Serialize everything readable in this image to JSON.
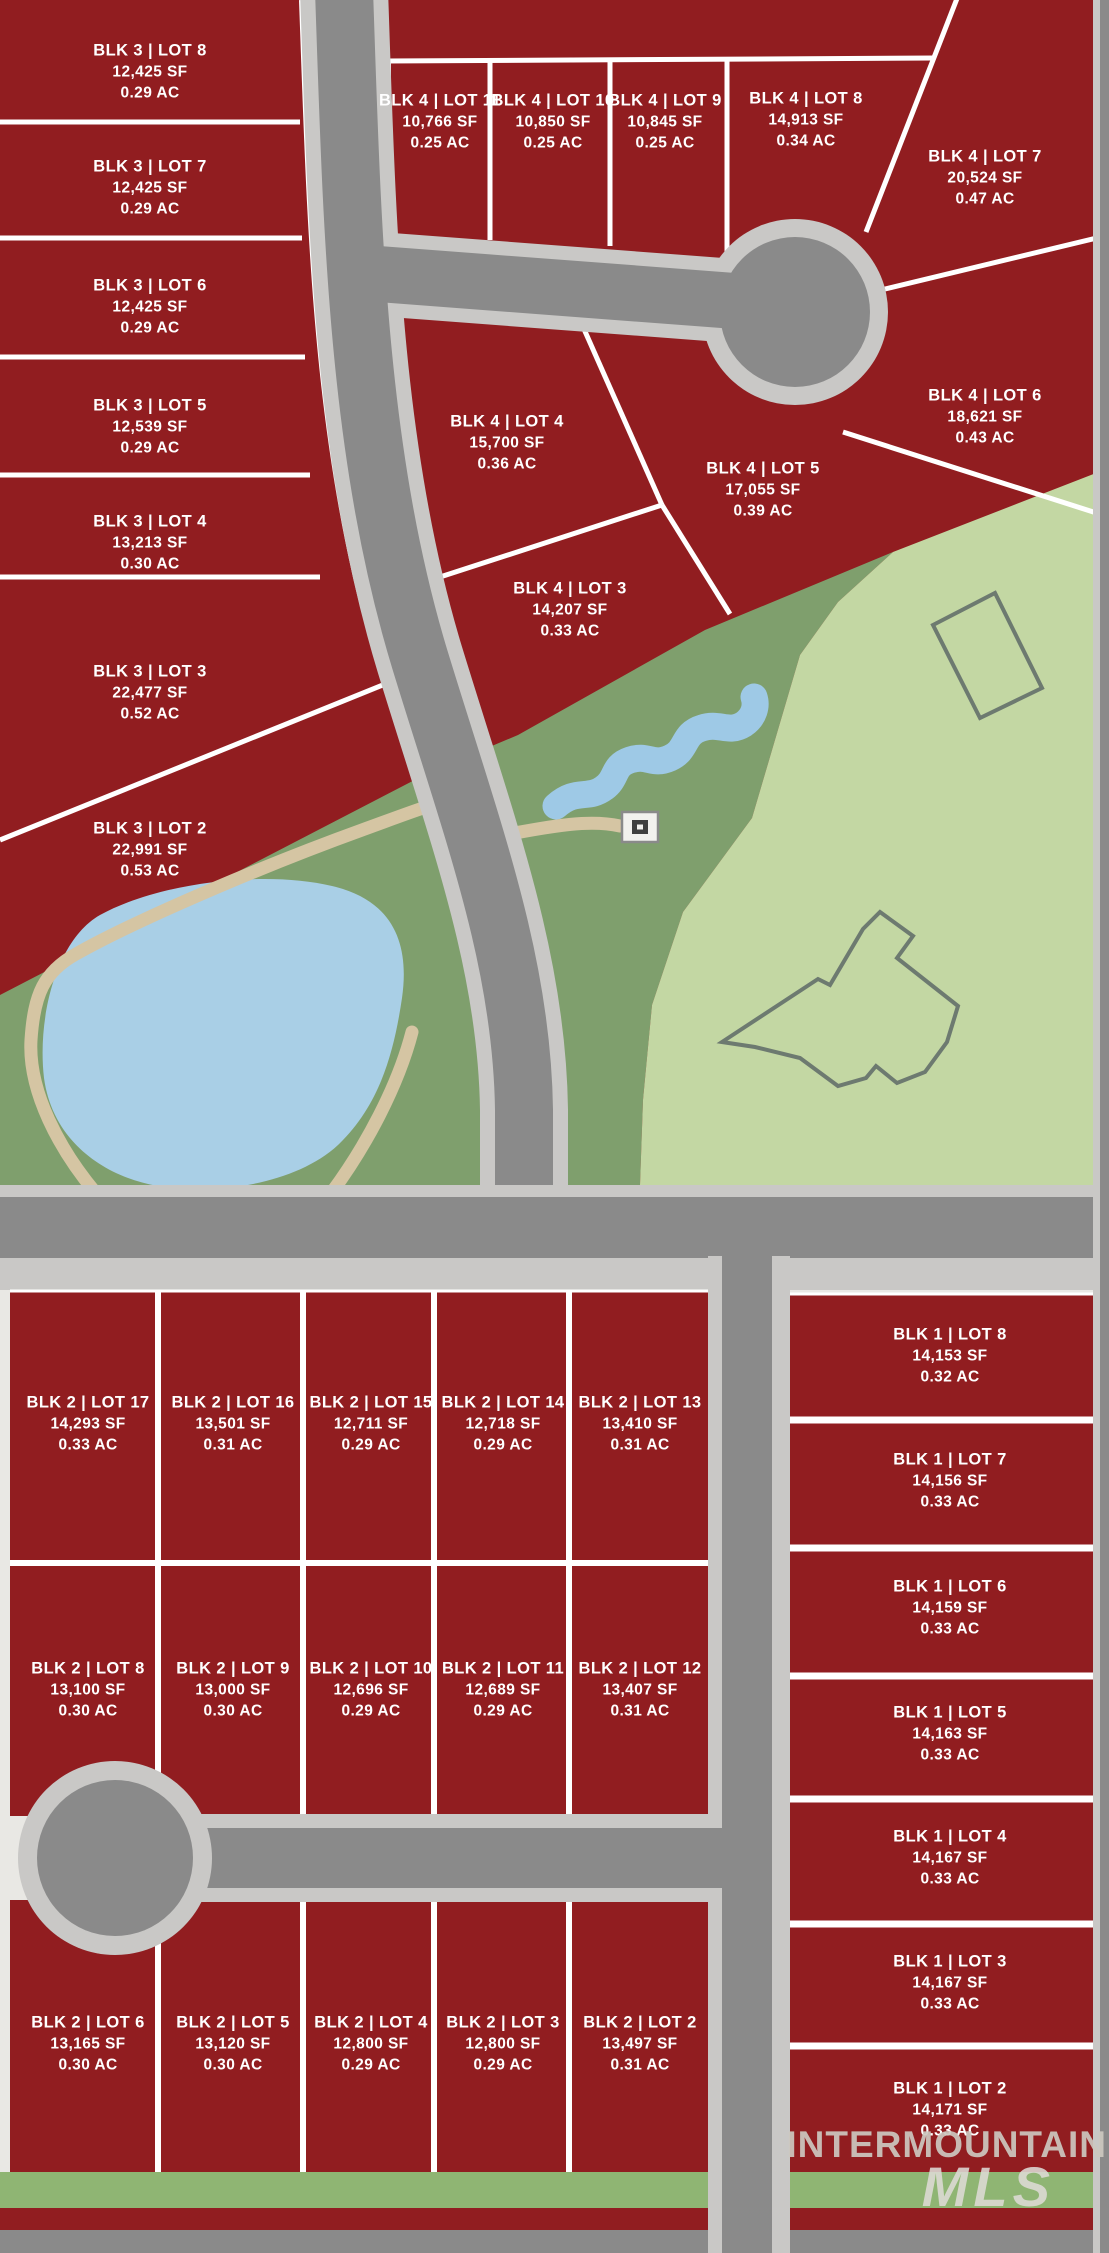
{
  "map": {
    "width": 1109,
    "height": 2253,
    "kind": "subdivision-plat-map"
  },
  "palette": {
    "page_bg": "#e9e8e4",
    "lot_red": "#911d20",
    "line_white": "#ffffff",
    "road_dark": "#8a8a8a",
    "road_light": "#c9c8c6",
    "park_dark_green": "#7f9f6d",
    "park_light_green": "#c3d7a3",
    "pond_blue": "#a9cfe6",
    "creek_blue": "#9ec9e6",
    "trail_tan": "#d5c5a3",
    "strip_green": "#8fb573",
    "outline_gray": "#6d7a70",
    "icon_dark": "#3f3f3f",
    "icon_light": "#f2f1ee",
    "label_white": "#ffffff",
    "wm_gray": "#cdc8c0",
    "wm_light": "#dedbd5"
  },
  "watermark": {
    "line1": "INTERMOUNTAIN",
    "line2": "MLS"
  },
  "blocks": [
    {
      "id": "blk3",
      "lots": [
        {
          "name": "BLK 3 | LOT 8",
          "sf": "12,425 SF",
          "ac": "0.29 AC",
          "x": 150,
          "y": 72
        },
        {
          "name": "BLK 3 | LOT 7",
          "sf": "12,425 SF",
          "ac": "0.29 AC",
          "x": 150,
          "y": 188
        },
        {
          "name": "BLK 3 | LOT 6",
          "sf": "12,425 SF",
          "ac": "0.29 AC",
          "x": 150,
          "y": 307
        },
        {
          "name": "BLK 3 | LOT 5",
          "sf": "12,539 SF",
          "ac": "0.29 AC",
          "x": 150,
          "y": 427
        },
        {
          "name": "BLK 3 | LOT 4",
          "sf": "13,213 SF",
          "ac": "0.30 AC",
          "x": 150,
          "y": 543
        },
        {
          "name": "BLK 3 | LOT 3",
          "sf": "22,477 SF",
          "ac": "0.52 AC",
          "x": 150,
          "y": 693
        },
        {
          "name": "BLK 3 | LOT 2",
          "sf": "22,991 SF",
          "ac": "0.53 AC",
          "x": 150,
          "y": 850
        }
      ]
    },
    {
      "id": "blk4",
      "lots": [
        {
          "name": "BLK 4 | LOT 11",
          "sf": "10,766 SF",
          "ac": "0.25 AC",
          "x": 440,
          "y": 122
        },
        {
          "name": "BLK 4 | LOT 10",
          "sf": "10,850 SF",
          "ac": "0.25 AC",
          "x": 553,
          "y": 122
        },
        {
          "name": "BLK 4 | LOT 9",
          "sf": "10,845 SF",
          "ac": "0.25 AC",
          "x": 665,
          "y": 122
        },
        {
          "name": "BLK 4 | LOT 8",
          "sf": "14,913 SF",
          "ac": "0.34 AC",
          "x": 806,
          "y": 120
        },
        {
          "name": "BLK 4 | LOT 7",
          "sf": "20,524 SF",
          "ac": "0.47 AC",
          "x": 985,
          "y": 178
        },
        {
          "name": "BLK 4 | LOT 6",
          "sf": "18,621 SF",
          "ac": "0.43 AC",
          "x": 985,
          "y": 417
        },
        {
          "name": "BLK 4 | LOT 4",
          "sf": "15,700 SF",
          "ac": "0.36 AC",
          "x": 507,
          "y": 443
        },
        {
          "name": "BLK 4 | LOT 5",
          "sf": "17,055 SF",
          "ac": "0.39 AC",
          "x": 763,
          "y": 490
        },
        {
          "name": "BLK 4 | LOT 3",
          "sf": "14,207 SF",
          "ac": "0.33 AC",
          "x": 570,
          "y": 610
        }
      ]
    },
    {
      "id": "blk2",
      "lots": [
        {
          "name": "BLK 2 | LOT 17",
          "sf": "14,293 SF",
          "ac": "0.33 AC",
          "x": 88,
          "y": 1424
        },
        {
          "name": "BLK 2 | LOT 16",
          "sf": "13,501 SF",
          "ac": "0.31 AC",
          "x": 233,
          "y": 1424
        },
        {
          "name": "BLK 2 | LOT 15",
          "sf": "12,711 SF",
          "ac": "0.29 AC",
          "x": 371,
          "y": 1424
        },
        {
          "name": "BLK 2 | LOT 14",
          "sf": "12,718 SF",
          "ac": "0.29 AC",
          "x": 503,
          "y": 1424
        },
        {
          "name": "BLK 2 | LOT 13",
          "sf": "13,410 SF",
          "ac": "0.31 AC",
          "x": 640,
          "y": 1424
        },
        {
          "name": "BLK 2 | LOT 8",
          "sf": "13,100 SF",
          "ac": "0.30 AC",
          "x": 88,
          "y": 1690
        },
        {
          "name": "BLK 2 | LOT 9",
          "sf": "13,000 SF",
          "ac": "0.30 AC",
          "x": 233,
          "y": 1690
        },
        {
          "name": "BLK 2 | LOT 10",
          "sf": "12,696 SF",
          "ac": "0.29 AC",
          "x": 371,
          "y": 1690
        },
        {
          "name": "BLK 2 | LOT 11",
          "sf": "12,689 SF",
          "ac": "0.29 AC",
          "x": 503,
          "y": 1690
        },
        {
          "name": "BLK 2 | LOT 12",
          "sf": "13,407 SF",
          "ac": "0.31 AC",
          "x": 640,
          "y": 1690
        },
        {
          "name": "BLK 2 | LOT 6",
          "sf": "13,165 SF",
          "ac": "0.30 AC",
          "x": 88,
          "y": 2044
        },
        {
          "name": "BLK 2 | LOT 5",
          "sf": "13,120 SF",
          "ac": "0.30 AC",
          "x": 233,
          "y": 2044
        },
        {
          "name": "BLK 2 | LOT 4",
          "sf": "12,800 SF",
          "ac": "0.29 AC",
          "x": 371,
          "y": 2044
        },
        {
          "name": "BLK 2 | LOT 3",
          "sf": "12,800 SF",
          "ac": "0.29 AC",
          "x": 503,
          "y": 2044
        },
        {
          "name": "BLK 2 | LOT 2",
          "sf": "13,497 SF",
          "ac": "0.31 AC",
          "x": 640,
          "y": 2044
        }
      ]
    },
    {
      "id": "blk1",
      "lots": [
        {
          "name": "BLK 1 | LOT 8",
          "sf": "14,153 SF",
          "ac": "0.32 AC",
          "x": 950,
          "y": 1356
        },
        {
          "name": "BLK 1 | LOT 7",
          "sf": "14,156 SF",
          "ac": "0.33 AC",
          "x": 950,
          "y": 1481
        },
        {
          "name": "BLK 1 | LOT 6",
          "sf": "14,159 SF",
          "ac": "0.33 AC",
          "x": 950,
          "y": 1608
        },
        {
          "name": "BLK 1 | LOT 5",
          "sf": "14,163 SF",
          "ac": "0.33 AC",
          "x": 950,
          "y": 1734
        },
        {
          "name": "BLK 1 | LOT 4",
          "sf": "14,167 SF",
          "ac": "0.33 AC",
          "x": 950,
          "y": 1858
        },
        {
          "name": "BLK 1 | LOT 3",
          "sf": "14,167 SF",
          "ac": "0.33 AC",
          "x": 950,
          "y": 1983
        },
        {
          "name": "BLK 1 | LOT 2",
          "sf": "14,171 SF",
          "ac": "0.33 AC",
          "x": 950,
          "y": 2110
        }
      ]
    }
  ]
}
